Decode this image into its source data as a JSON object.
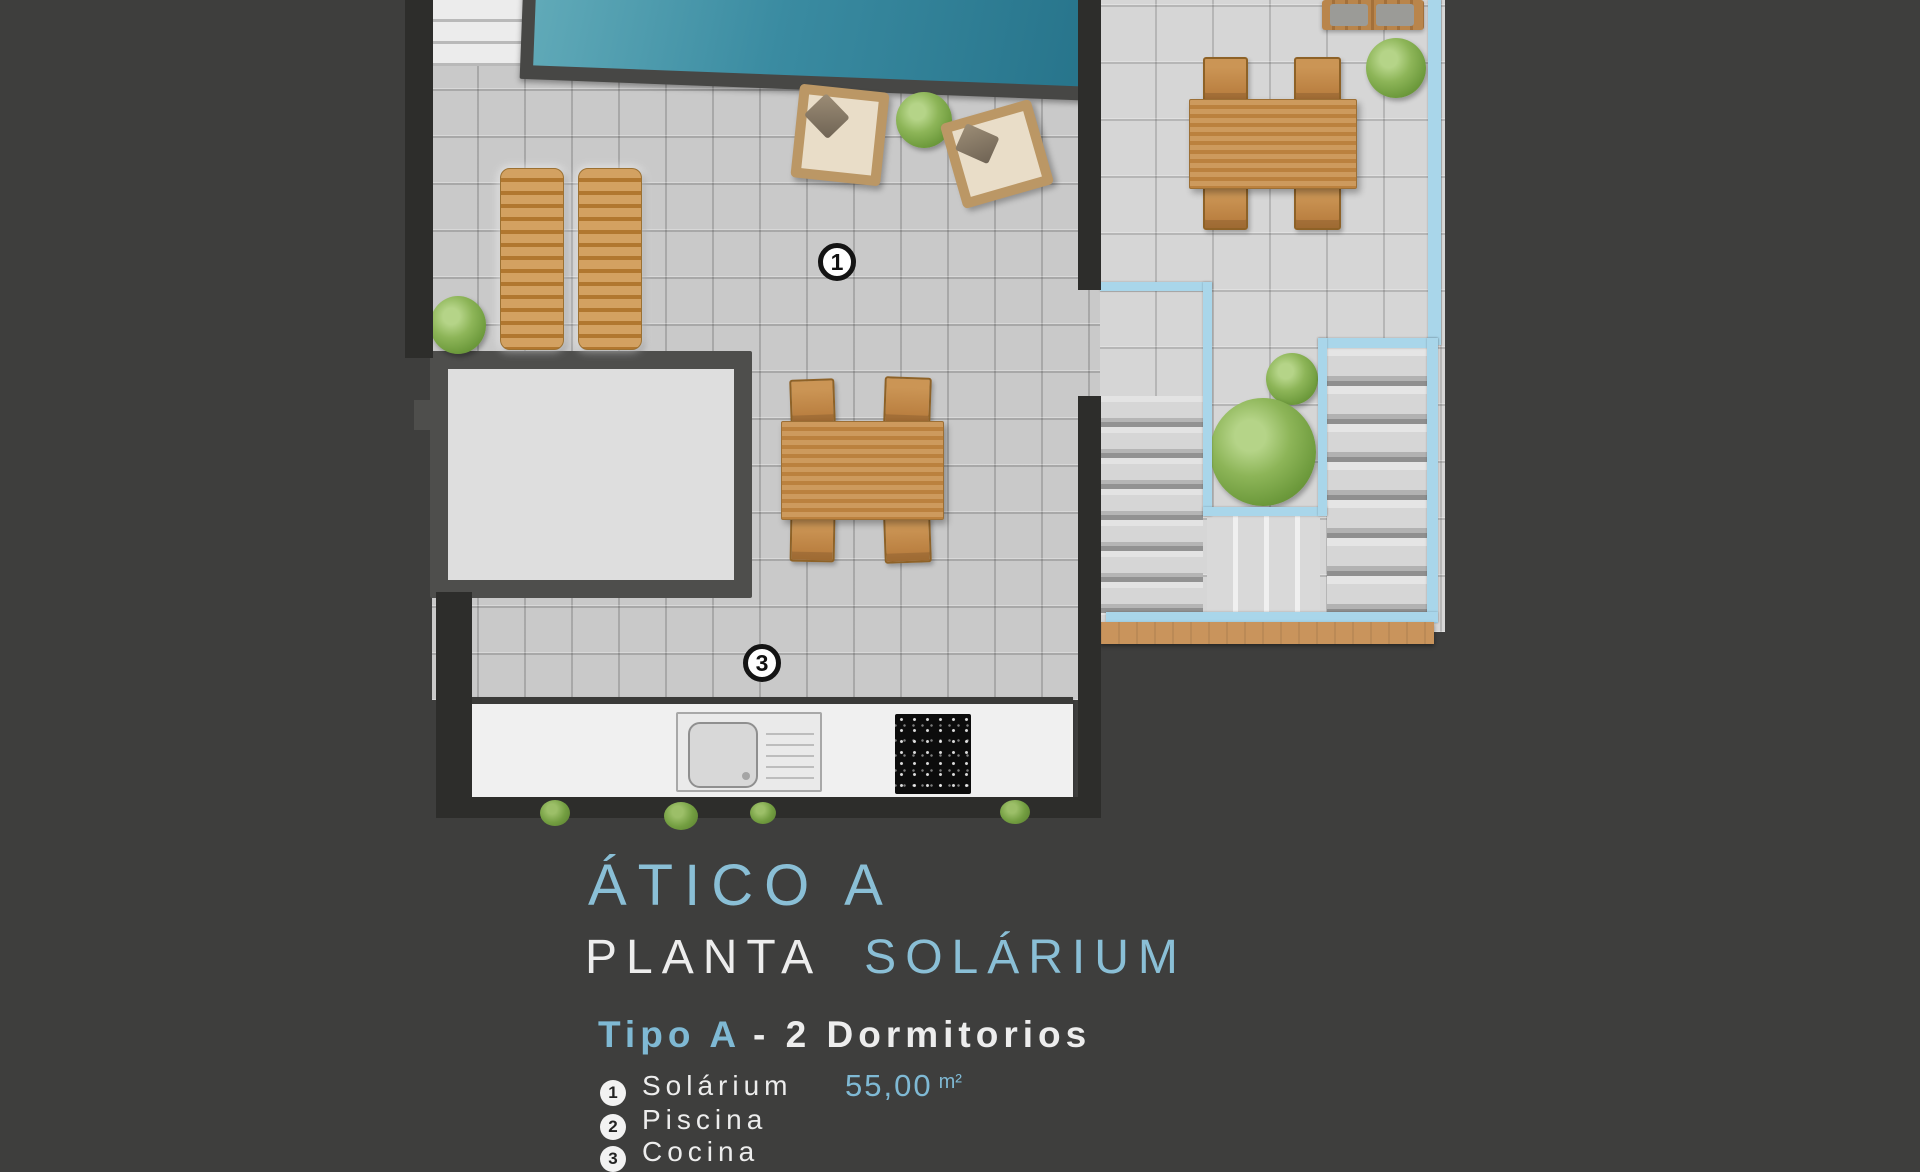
{
  "plan": {
    "markers": {
      "solarium": "1",
      "kitchen": "3"
    },
    "colors": {
      "background": "#3e3e3d",
      "pool_water": "#3a8ba1",
      "wall_dark": "#2d2d2b",
      "wall_medium": "#4e4e4c",
      "tile_main": "#c9c9c9",
      "tile_right": "#d6d6d6",
      "wood": "#c08a4e",
      "glass_railing": "#a9d6ea",
      "deck_wood": "#c9945c"
    }
  },
  "legend": {
    "title": "ÁTICO A",
    "subtitle_white": "PLANTA",
    "subtitle_blue": "SOLÁRIUM",
    "type_blue": "Tipo A",
    "type_white": "- 2  Dormitorios",
    "items": [
      {
        "num": "1",
        "label": "Solárium",
        "area": "55,00",
        "unit": "m²"
      },
      {
        "num": "2",
        "label": "Piscina",
        "area": "",
        "unit": ""
      },
      {
        "num": "3",
        "label": "Cocina",
        "area": "",
        "unit": ""
      }
    ]
  }
}
